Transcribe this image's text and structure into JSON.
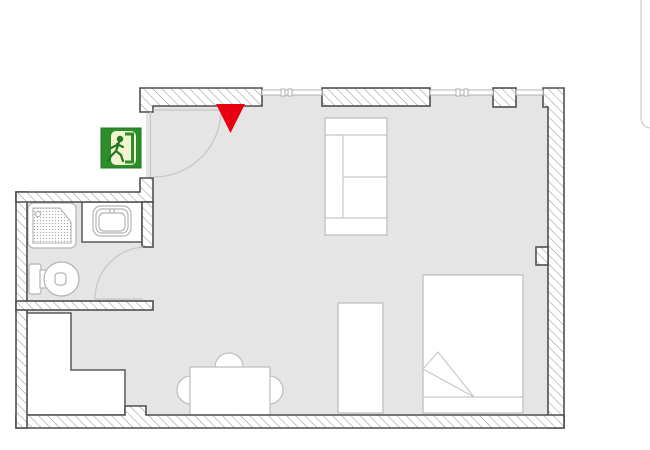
{
  "plan": {
    "canvas": {
      "width": 650,
      "height": 450
    },
    "colors": {
      "floor": "#e5e5e5",
      "wall_border": "#4f4f4f",
      "hatch_line": "#9a9a9a",
      "furniture_stroke": "#c0c0c0",
      "fixture_stroke": "#b3b3b3",
      "exit_sign_green": "#2b8e2b",
      "exit_sign_panel": "#f2f3cf",
      "exit_sign_figure": "#1e7a1e",
      "marker_red": "#e80012",
      "panel_edge": "#cfcfcf"
    },
    "legend": {
      "rooms": [
        "main-room",
        "bathroom"
      ],
      "markers": [
        "emergency-exit-sign",
        "location-marker"
      ],
      "furniture": [
        "sofa",
        "bed",
        "desk",
        "dining-table",
        "chairs",
        "kitchen-counter",
        "shower",
        "sink",
        "toilet"
      ]
    },
    "shapes": [
      {
        "t": "rect",
        "name": "main-room-floor",
        "cls": "floor",
        "a": {
          "x": 146,
          "y": 93,
          "width": 402,
          "height": 322
        }
      },
      {
        "t": "rect",
        "name": "alcove-floor",
        "cls": "floor",
        "a": {
          "x": 27,
          "y": 310,
          "width": 119,
          "height": 105
        }
      },
      {
        "t": "rect",
        "name": "bathroom-floor",
        "cls": "floor",
        "a": {
          "x": 27,
          "y": 202,
          "width": 115,
          "height": 99
        }
      },
      {
        "t": "rect",
        "name": "bathroom-door-gap-floor",
        "cls": "floor",
        "a": {
          "x": 142,
          "y": 247,
          "width": 11,
          "height": 54
        }
      },
      {
        "t": "rect",
        "name": "sink-counter",
        "cls": "counter",
        "a": {
          "x": 82,
          "y": 202,
          "width": 60,
          "height": 40
        }
      },
      {
        "t": "rect",
        "name": "shower-tray",
        "cls": "fixture",
        "a": {
          "x": 28,
          "y": 203,
          "width": 48,
          "height": 45,
          "rx": 6
        }
      },
      {
        "t": "path",
        "name": "shower-floor-texture",
        "cls": "",
        "a": {
          "d": "M33,208 L60,208 L71,222 L71,243 L33,243 Z",
          "fill": "url(#dots)",
          "stroke": "#b3b3b3",
          "stroke-width": 1.1
        }
      },
      {
        "t": "circle",
        "name": "shower-drain",
        "cls": "fixture",
        "a": {
          "cx": 38,
          "cy": 214,
          "r": 2.6
        }
      },
      {
        "t": "rect",
        "name": "toilet-tank",
        "cls": "fixture",
        "a": {
          "x": 29,
          "y": 264,
          "width": 12,
          "height": 30,
          "rx": 2
        }
      },
      {
        "t": "rect",
        "name": "toilet-connector",
        "cls": "fixture",
        "a": {
          "x": 40,
          "y": 270,
          "width": 6,
          "height": 18
        }
      },
      {
        "t": "ellipse",
        "name": "toilet-bowl",
        "cls": "fixture",
        "a": {
          "cx": 61.5,
          "cy": 279,
          "rx": 17.5,
          "ry": 17
        }
      },
      {
        "t": "rect",
        "name": "toilet-drain",
        "cls": "fixture",
        "a": {
          "x": 55,
          "y": 273,
          "width": 11,
          "height": 12,
          "rx": 3.5
        }
      },
      {
        "t": "rect",
        "name": "sink-outer",
        "cls": "fixture",
        "a": {
          "x": 93,
          "y": 206,
          "width": 38,
          "height": 30,
          "rx": 8
        }
      },
      {
        "t": "rect",
        "name": "sink-mid",
        "cls": "fixture",
        "a": {
          "x": 96,
          "y": 209,
          "width": 32,
          "height": 24,
          "rx": 6
        }
      },
      {
        "t": "rect",
        "name": "sink-bowl",
        "cls": "fixture",
        "a": {
          "x": 99,
          "y": 213,
          "width": 26,
          "height": 18,
          "rx": 5
        }
      },
      {
        "t": "circle",
        "name": "sink-faucet",
        "cls": "fixture",
        "a": {
          "cx": 112,
          "cy": 211,
          "r": 2.2
        }
      },
      {
        "t": "rect",
        "name": "sofa",
        "cls": "furn",
        "a": {
          "x": 325,
          "y": 118,
          "width": 62,
          "height": 117
        }
      },
      {
        "t": "line",
        "name": "sofa-divider-top",
        "cls": "furnline",
        "a": {
          "x1": 325,
          "y1": 135,
          "x2": 387,
          "y2": 135
        }
      },
      {
        "t": "line",
        "name": "sofa-divider-bottom",
        "cls": "furnline",
        "a": {
          "x1": 325,
          "y1": 218,
          "x2": 387,
          "y2": 218
        }
      },
      {
        "t": "line",
        "name": "sofa-backrest-line",
        "cls": "furnline",
        "a": {
          "x1": 343,
          "y1": 135,
          "x2": 343,
          "y2": 218
        }
      },
      {
        "t": "line",
        "name": "sofa-cushion-line",
        "cls": "furnline",
        "a": {
          "x1": 343,
          "y1": 177,
          "x2": 387,
          "y2": 177
        }
      },
      {
        "t": "rect",
        "name": "desk",
        "cls": "furn",
        "a": {
          "x": 338,
          "y": 303,
          "width": 45,
          "height": 110
        }
      },
      {
        "t": "rect",
        "name": "bed",
        "cls": "furn",
        "a": {
          "x": 423,
          "y": 275,
          "width": 100,
          "height": 138
        }
      },
      {
        "t": "line",
        "name": "bed-blanket-line",
        "cls": "furnline",
        "a": {
          "x1": 423,
          "y1": 397,
          "x2": 523,
          "y2": 397
        }
      },
      {
        "t": "polygon",
        "name": "bed-blanket-fold",
        "cls": "furnline",
        "a": {
          "points": "423,369 438,352 474,397"
        }
      },
      {
        "t": "circle",
        "name": "chair-top",
        "cls": "furn",
        "a": {
          "cx": 229,
          "cy": 367,
          "r": 14
        }
      },
      {
        "t": "circle",
        "name": "chair-left",
        "cls": "furn",
        "a": {
          "cx": 191,
          "cy": 390,
          "r": 14
        }
      },
      {
        "t": "circle",
        "name": "chair-right",
        "cls": "furn",
        "a": {
          "cx": 269,
          "cy": 390,
          "r": 14
        }
      },
      {
        "t": "rect",
        "name": "dining-table",
        "cls": "furn",
        "a": {
          "x": 190,
          "y": 367,
          "width": 80,
          "height": 48
        }
      },
      {
        "t": "polygon",
        "name": "kitchen-counter",
        "cls": "counter",
        "a": {
          "points": "26,313 71,313 71,370 125,370 125,415 26,415"
        }
      },
      {
        "t": "path",
        "name": "top-wall-entrance",
        "cls": "wall",
        "a": {
          "d": "M140,88 H262 V106 H153 V112 H140 Z"
        }
      },
      {
        "t": "rect",
        "name": "top-wall-middle",
        "cls": "wall",
        "a": {
          "x": 322,
          "y": 88,
          "width": 108,
          "height": 18
        }
      },
      {
        "t": "rect",
        "name": "top-wall-pillar",
        "cls": "wall",
        "a": {
          "x": 493,
          "y": 88,
          "width": 23,
          "height": 19
        }
      },
      {
        "t": "path",
        "name": "right-wall",
        "cls": "wall",
        "a": {
          "d": "M543,88 H564 V428 H548 V107 H543 Z"
        }
      },
      {
        "t": "rect",
        "name": "right-wall-bump",
        "cls": "wall",
        "a": {
          "x": 536,
          "y": 247,
          "width": 12,
          "height": 18
        }
      },
      {
        "t": "path",
        "name": "bottom-wall",
        "cls": "wall",
        "a": {
          "d": "M16,415 H125 V406 H146 V415 H564 V428 H16 Z"
        }
      },
      {
        "t": "rect",
        "name": "left-wall",
        "cls": "wall",
        "a": {
          "x": 16,
          "y": 192,
          "width": 11,
          "height": 236
        }
      },
      {
        "t": "path",
        "name": "bathroom-top-wall",
        "cls": "wall",
        "a": {
          "d": "M16,192 H140 V178 H153 V202 H16 Z"
        }
      },
      {
        "t": "rect",
        "name": "bathroom-right-wall",
        "cls": "wall",
        "a": {
          "x": 142,
          "y": 202,
          "width": 11,
          "height": 45
        }
      },
      {
        "t": "rect",
        "name": "bathroom-bottom-wall",
        "cls": "wall",
        "a": {
          "x": 16,
          "y": 301,
          "width": 137,
          "height": 9
        }
      },
      {
        "t": "rect",
        "name": "window-1",
        "cls": "window",
        "a": {
          "x": 262,
          "y": 90,
          "width": 60,
          "height": 5
        }
      },
      {
        "t": "rect",
        "name": "window-1-tick-a",
        "cls": "window",
        "a": {
          "x": 281,
          "y": 89,
          "width": 4,
          "height": 7
        }
      },
      {
        "t": "rect",
        "name": "window-1-tick-b",
        "cls": "window",
        "a": {
          "x": 288,
          "y": 89,
          "width": 4,
          "height": 7
        }
      },
      {
        "t": "rect",
        "name": "window-2",
        "cls": "window",
        "a": {
          "x": 430,
          "y": 90,
          "width": 63,
          "height": 5
        }
      },
      {
        "t": "rect",
        "name": "window-2-tick-a",
        "cls": "window",
        "a": {
          "x": 456,
          "y": 89,
          "width": 4,
          "height": 7
        }
      },
      {
        "t": "rect",
        "name": "window-2-tick-b",
        "cls": "window",
        "a": {
          "x": 464,
          "y": 89,
          "width": 4,
          "height": 7
        }
      },
      {
        "t": "rect",
        "name": "window-3",
        "cls": "window",
        "a": {
          "x": 516,
          "y": 90,
          "width": 27,
          "height": 5
        }
      },
      {
        "t": "line",
        "name": "entrance-door-leaf",
        "cls": "door",
        "a": {
          "x1": 153,
          "y1": 110,
          "x2": 221,
          "y2": 110
        }
      },
      {
        "t": "line",
        "name": "entrance-door-jamb-line",
        "cls": "door",
        "a": {
          "x1": 150.5,
          "y1": 112,
          "x2": 150.5,
          "y2": 177
        }
      },
      {
        "t": "path",
        "name": "entrance-door-swing",
        "cls": "door",
        "a": {
          "d": "M221,110 A67,67 0 0 1 153,177"
        }
      },
      {
        "t": "line",
        "name": "bathroom-door-leaf",
        "cls": "door",
        "a": {
          "x1": 143,
          "y1": 299,
          "x2": 95,
          "y2": 299
        }
      },
      {
        "t": "path",
        "name": "bathroom-door-swing",
        "cls": "door",
        "a": {
          "d": "M95,299 A52,52 0 0 1 143,247"
        }
      },
      {
        "t": "rect",
        "name": "exit-sign-background",
        "cls": "",
        "a": {
          "x": 101,
          "y": 128,
          "width": 40,
          "height": 40,
          "fill": "#2b8e2b",
          "stroke": "#20761f",
          "stroke-width": 1
        }
      },
      {
        "t": "rect",
        "name": "exit-sign-door-panel",
        "cls": "",
        "a": {
          "x": 111,
          "y": 131,
          "width": 25,
          "height": 34,
          "rx": 5,
          "fill": "#f2f3cf"
        }
      },
      {
        "t": "path",
        "name": "exit-sign-door-frame",
        "cls": "",
        "a": {
          "d": "M125,134 H132.5 V162 H125",
          "fill": "none",
          "stroke": "#2b8e2b",
          "stroke-width": 3
        }
      },
      {
        "t": "circle",
        "name": "exit-sign-figure-head",
        "cls": "",
        "a": {
          "cx": 120,
          "cy": 139,
          "r": 3.2,
          "fill": "#1e7a1e"
        }
      },
      {
        "t": "path",
        "name": "exit-sign-figure-body",
        "cls": "",
        "a": {
          "d": "M119,142 L116,151 L121,155 L123,161 M116,151 L111,156 L108,161 M117,144 L123,147 M117,145 L111,148",
          "fill": "none",
          "stroke": "#1e7a1e",
          "stroke-width": 2.2,
          "stroke-linecap": "round"
        }
      },
      {
        "t": "polygon",
        "name": "location-marker",
        "cls": "",
        "a": {
          "points": "216,104 245,104 230.5,133",
          "fill": "#e80012"
        }
      },
      {
        "t": "path",
        "name": "panel-edge",
        "cls": "",
        "a": {
          "d": "M641,0 L641,117 Q641,128 652,128",
          "fill": "none",
          "stroke": "#cfcfcf",
          "stroke-width": 1.3
        }
      }
    ]
  }
}
